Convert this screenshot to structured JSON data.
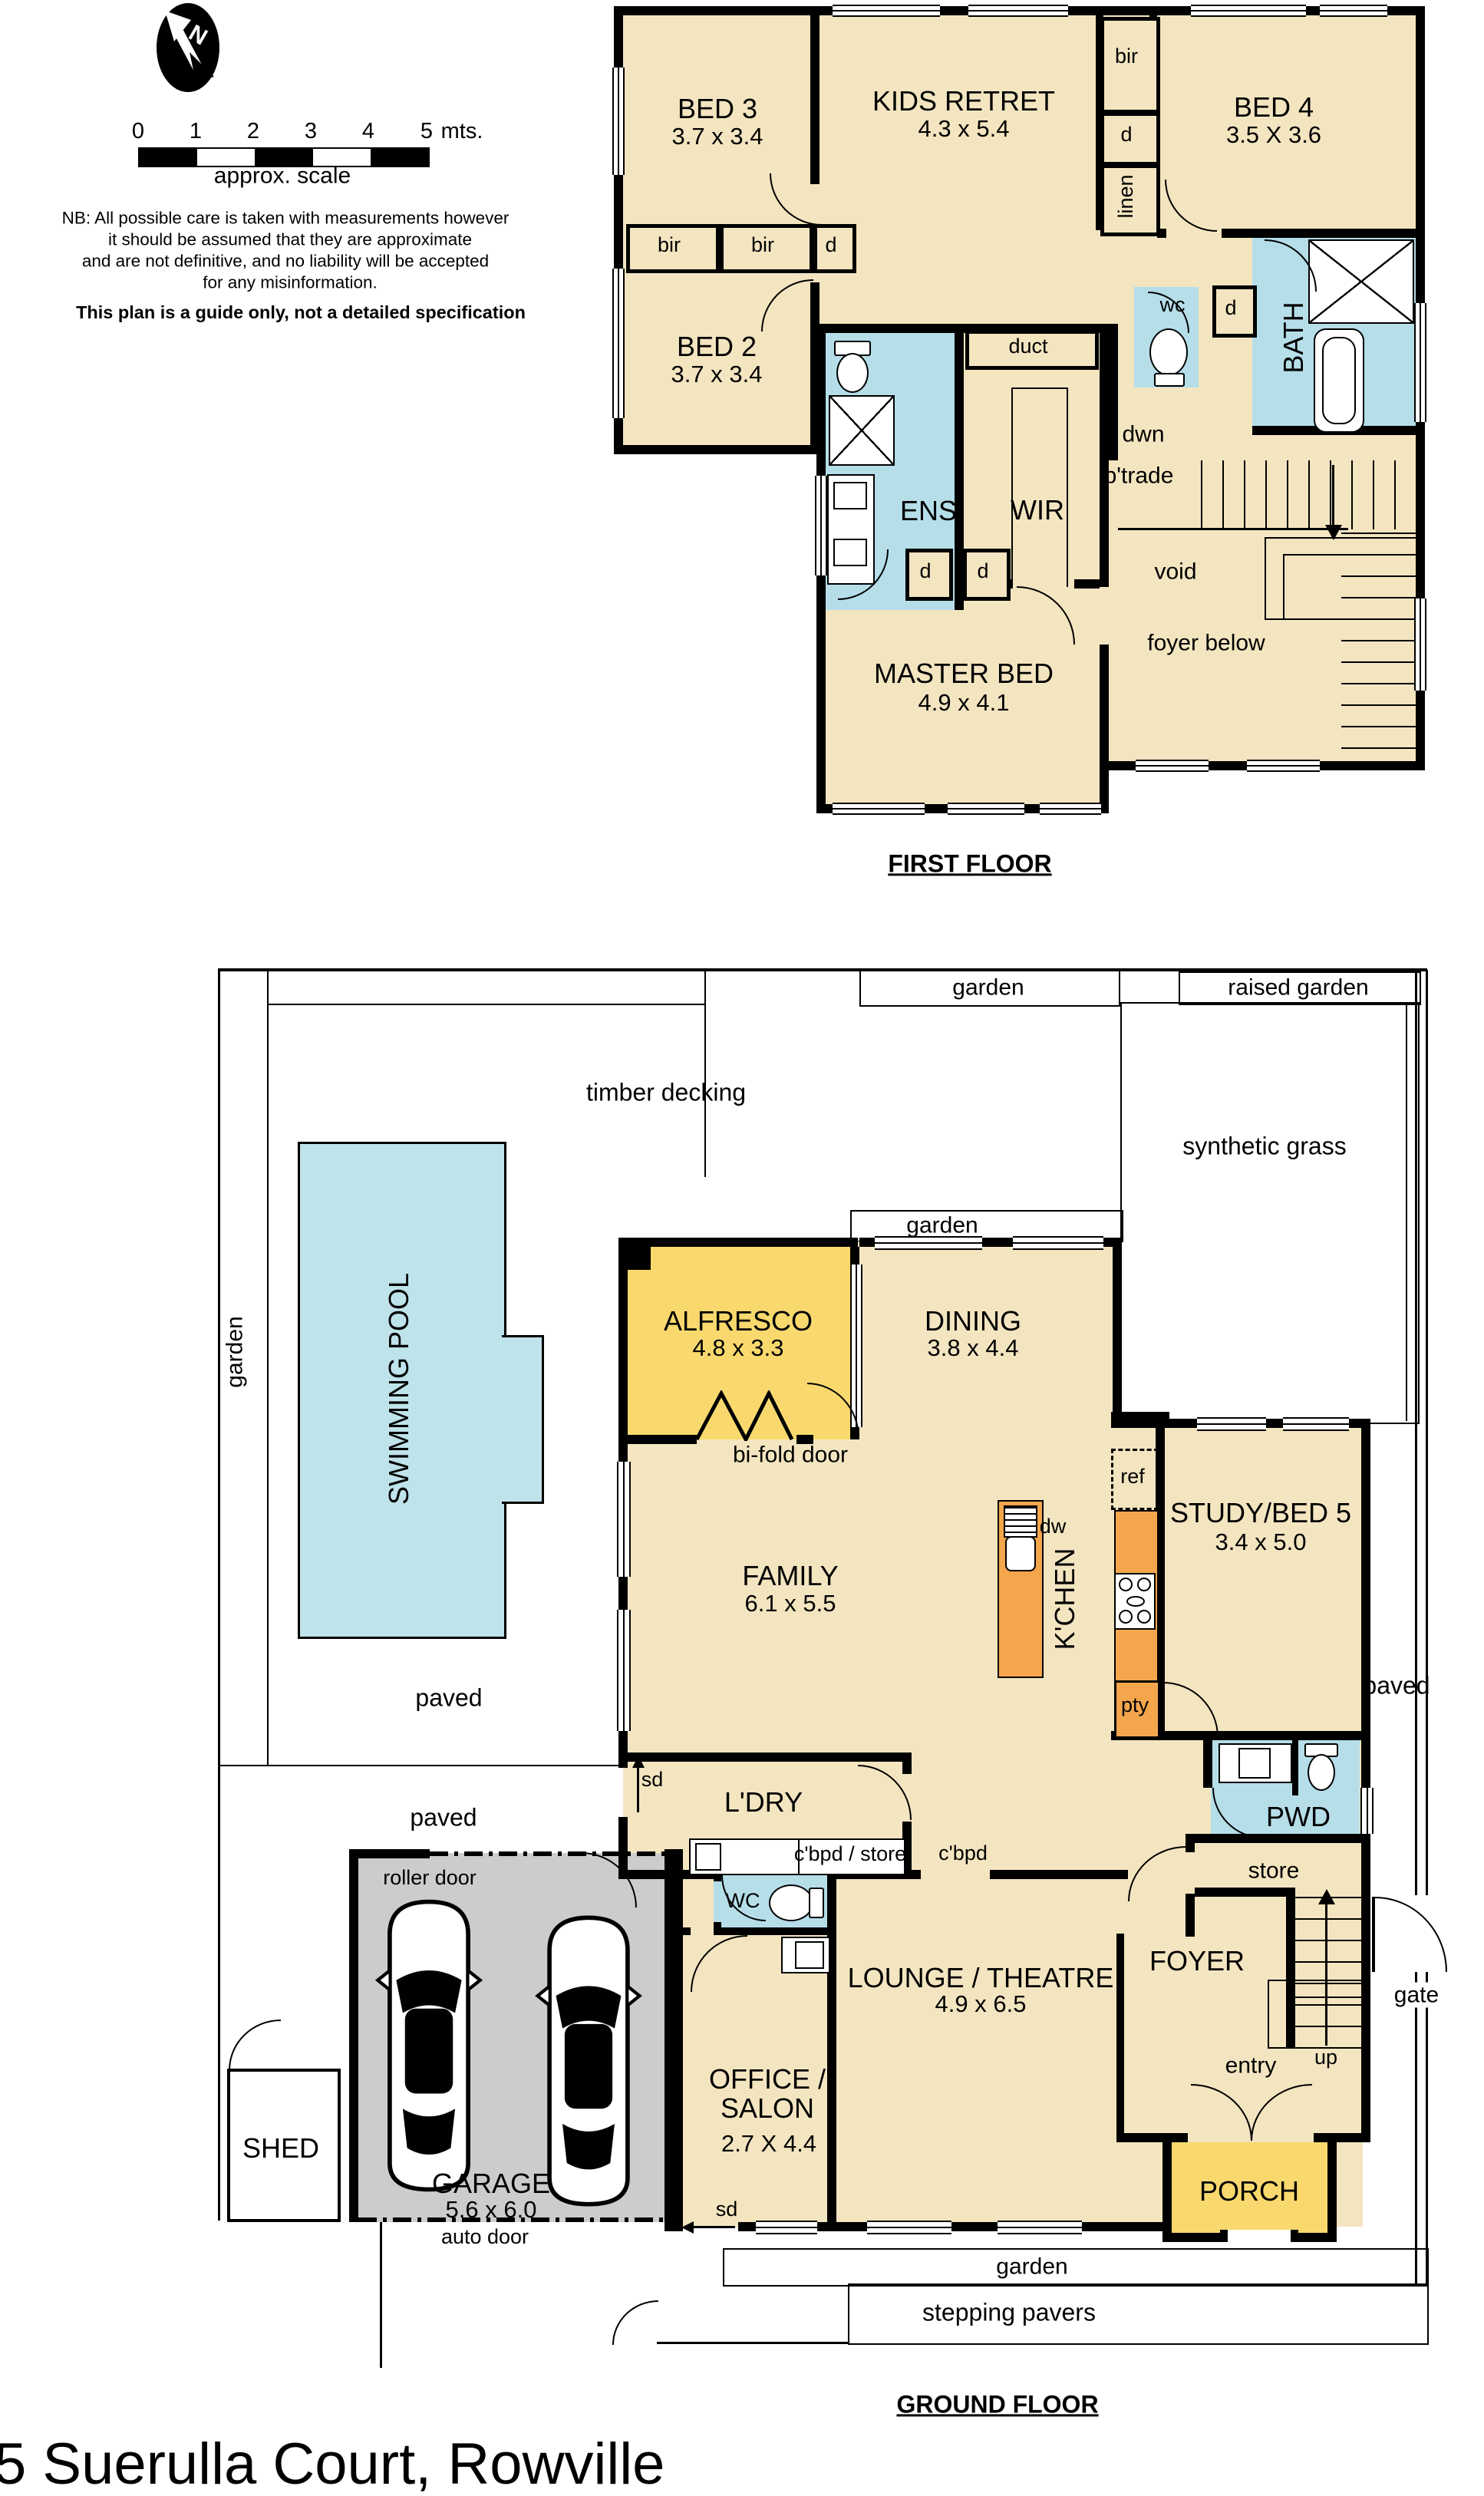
{
  "address": "5 Suerulla Court, Rowville",
  "legend": {
    "north": "N",
    "scale": {
      "ticks": [
        "0",
        "1",
        "2",
        "3",
        "4",
        "5"
      ],
      "unit": "mts.",
      "caption": "approx. scale"
    },
    "disclaimer": [
      "NB: All possible care is taken with measurements however",
      "it should be assumed that they are approximate",
      "and are not definitive, and no liability will be accepted",
      "for any misinformation."
    ],
    "note": "This plan is a guide only, not a detailed specification"
  },
  "first_floor": {
    "title": "FIRST FLOOR",
    "bed3": {
      "name": "BED 3",
      "dims": "3.7 x 3.4"
    },
    "kids_retreat": {
      "name": "KIDS RETRET",
      "dims": "4.3 x 5.4"
    },
    "bed4": {
      "name": "BED 4",
      "dims": "3.5 X 3.6"
    },
    "bed2": {
      "name": "BED 2",
      "dims": "3.7 x 3.4"
    },
    "master": {
      "name": "MASTER BED",
      "dims": "4.9 x 4.1"
    },
    "ens": "ENS",
    "wir": "WIR",
    "bath": "BATH",
    "wc": "wc",
    "duct": "duct",
    "bir": "bir",
    "d": "d",
    "linen": "linen",
    "dwn": "dwn",
    "btrade": "b'trade",
    "void": "void",
    "foyer_below": "foyer below"
  },
  "ground_floor": {
    "title": "GROUND FLOOR",
    "alfresco": {
      "name": "ALFRESCO",
      "dims": "4.8 x 3.3"
    },
    "dining": {
      "name": "DINING",
      "dims": "3.8 x 4.4"
    },
    "family": {
      "name": "FAMILY",
      "dims": "6.1 x 5.5"
    },
    "study": {
      "name": "STUDY/BED 5",
      "dims": "3.4 x 5.0"
    },
    "garage": {
      "name": "GARAGE",
      "dims": "5.6 x 6.0"
    },
    "office": {
      "name1": "OFFICE /",
      "name2": "SALON",
      "dims": "2.7 X 4.4"
    },
    "lounge": {
      "name": "LOUNGE / THEATRE",
      "dims": "4.9 x 6.5"
    },
    "kitchen": "K'CHEN",
    "ldry": "L'DRY",
    "pwd": "PWD",
    "wc": "WC",
    "foyer": "FOYER",
    "porch": "PORCH",
    "shed": "SHED",
    "store": "store",
    "pty": "pty",
    "ref": "ref",
    "dw": "dw",
    "up": "up",
    "entry": "entry",
    "gate": "gate",
    "sd": "sd",
    "cbpd_store": "c'bpd / store",
    "cbpd": "c'bpd",
    "bifold": "bi-fold door",
    "roller": "roller door",
    "auto": "auto door",
    "swimming_pool": "SWIMMING POOL",
    "timber_decking": "timber decking",
    "synthetic_grass": "synthetic grass",
    "garden": "garden",
    "raised_garden": "raised garden",
    "paved": "paved",
    "stepping_pavers": "stepping pavers"
  }
}
